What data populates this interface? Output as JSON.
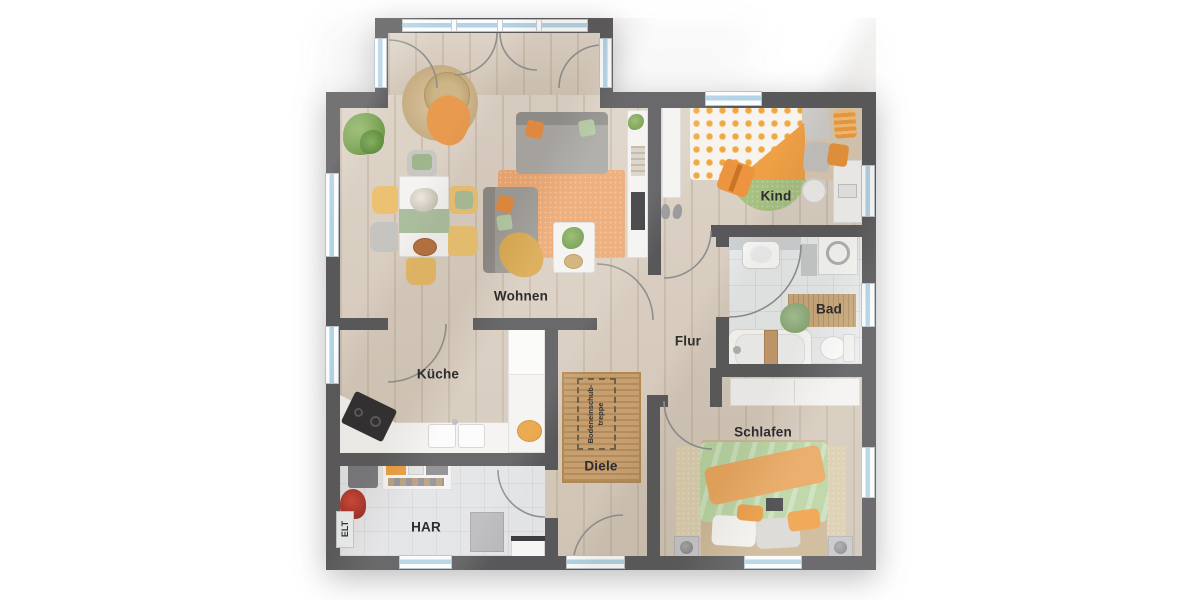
{
  "floorplan": {
    "type": "residential-ground-floor-plan",
    "rooms": {
      "wohnen": {
        "label": "Wohnen"
      },
      "kueche": {
        "label": "Küche"
      },
      "kind": {
        "label": "Kind"
      },
      "bad": {
        "label": "Bad"
      },
      "flur": {
        "label": "Flur"
      },
      "schlafen": {
        "label": "Schlafen"
      },
      "diele": {
        "label": "Diele"
      },
      "har": {
        "label": "HAR"
      },
      "elt": {
        "label": "ELT"
      },
      "attic_stairs": {
        "label_line1": "Bodeneinschub-",
        "label_line2": "treppe"
      }
    },
    "colors": {
      "wall": "#58585a",
      "floor_wood": "#d6cabb",
      "floor_tile_bad": "#e9ebec",
      "floor_tile_har": "#e2e3e5",
      "window_glass": "#b2d2e5",
      "window_frame": "#fbfcfd",
      "accent_orange": "#ea9b4e",
      "accent_green": "#b2cd9c",
      "accent_yellow": "#ecc272",
      "rug_jute": "#c79f6e",
      "rug_orange": "#eca771",
      "furniture_white": "#f4f3f1",
      "furniture_gray": "#a9a7a4",
      "label_text": "#2d2d2f"
    }
  }
}
